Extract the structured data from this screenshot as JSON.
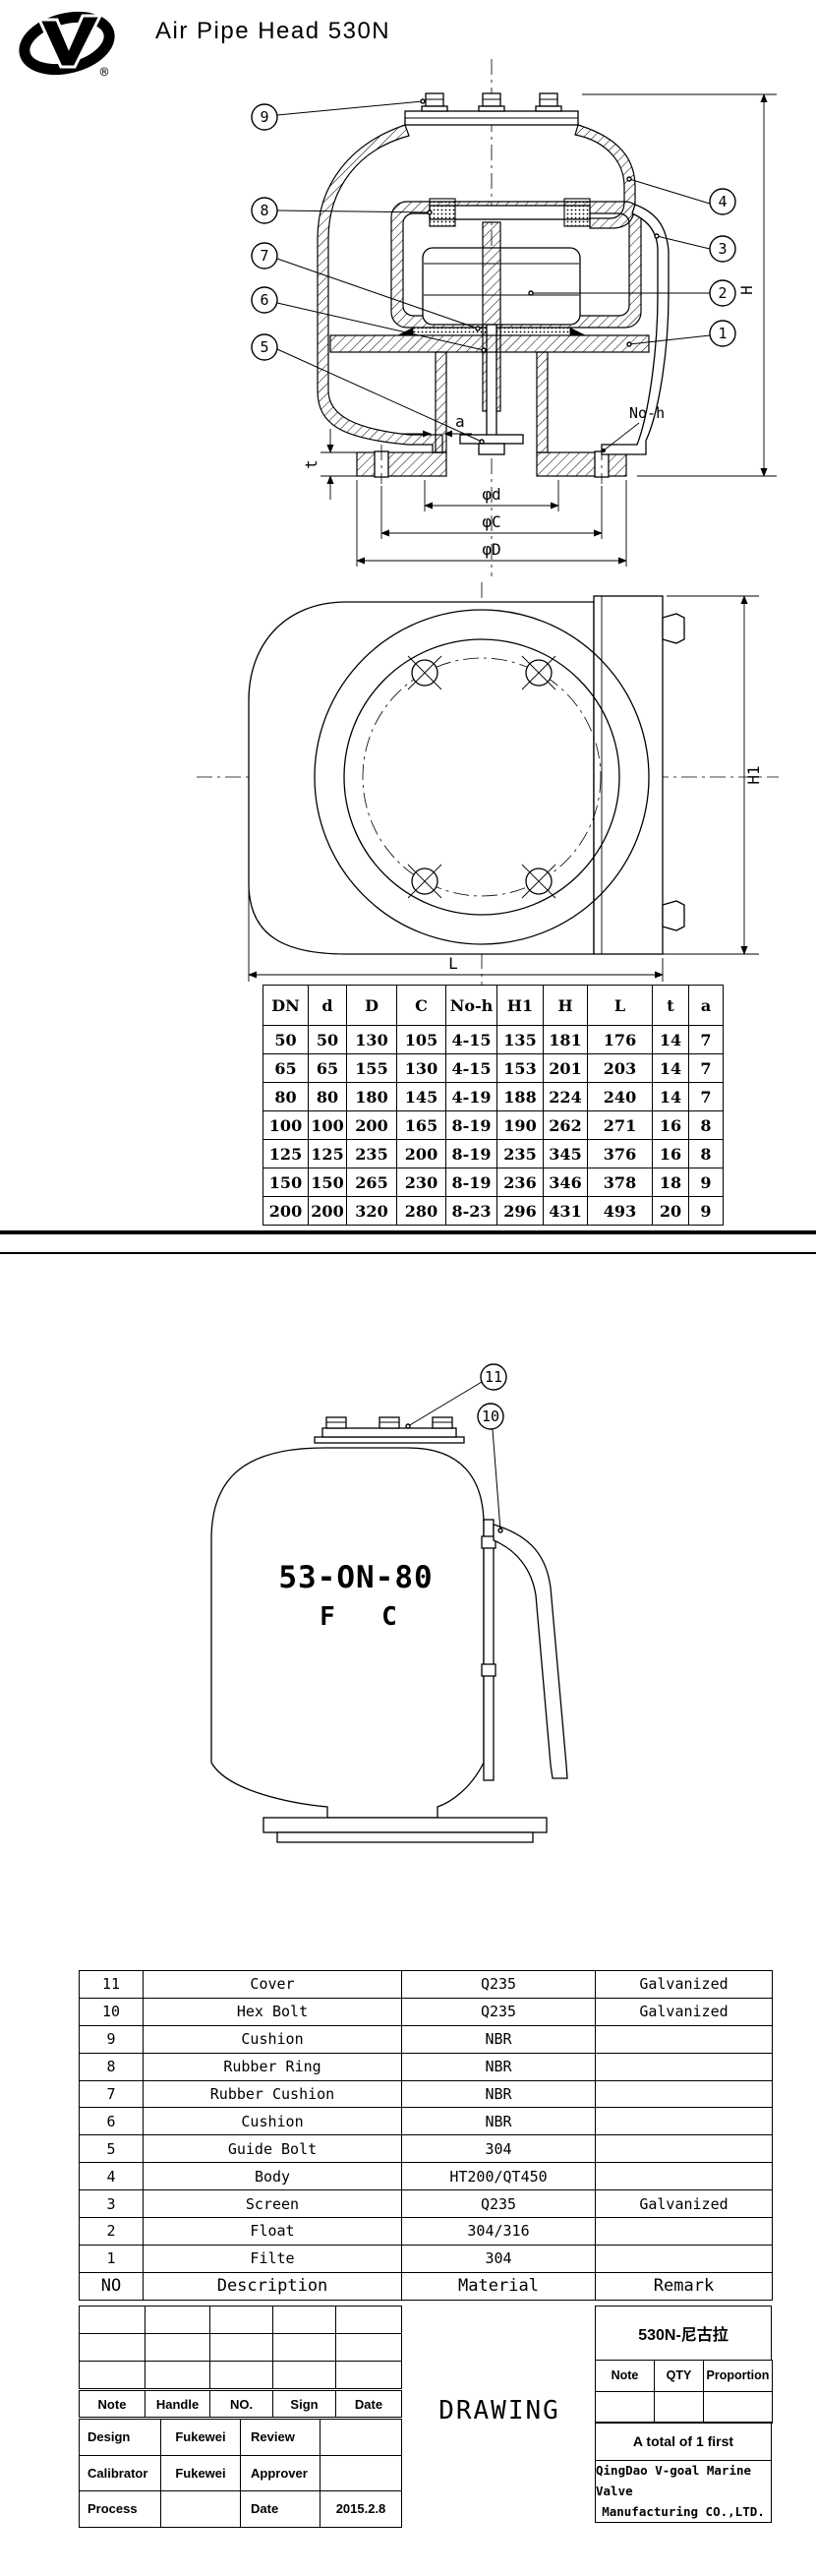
{
  "header": {
    "title": "Air Pipe Head  530N",
    "registered": "®"
  },
  "drawing1": {
    "callouts": [
      "1",
      "2",
      "3",
      "4",
      "5",
      "6",
      "7",
      "8",
      "9"
    ],
    "labels": {
      "a": "a",
      "t": "t",
      "phid": "φd",
      "phic": "φC",
      "phiD": "φD",
      "noh": "No-h",
      "H": "H"
    }
  },
  "top_view": {
    "labels": {
      "H1": "H1",
      "L": "L"
    }
  },
  "dim_table": {
    "header_rows": [
      [
        "DN",
        "d",
        "D",
        "C",
        "No-h",
        "H1",
        "H",
        "L",
        "t",
        "a"
      ]
    ],
    "rows": [
      [
        "50",
        "50",
        "130",
        "105",
        "4-15",
        "135",
        "181",
        "176",
        "14",
        "7"
      ],
      [
        "65",
        "65",
        "155",
        "130",
        "4-15",
        "153",
        "201",
        "203",
        "14",
        "7"
      ],
      [
        "80",
        "80",
        "180",
        "145",
        "4-19",
        "188",
        "224",
        "240",
        "14",
        "7"
      ],
      [
        "100",
        "100",
        "200",
        "165",
        "8-19",
        "190",
        "262",
        "271",
        "16",
        "8"
      ],
      [
        "125",
        "125",
        "235",
        "200",
        "8-19",
        "235",
        "345",
        "376",
        "16",
        "8"
      ],
      [
        "150",
        "150",
        "265",
        "230",
        "8-19",
        "236",
        "346",
        "378",
        "18",
        "9"
      ],
      [
        "200",
        "200",
        "320",
        "280",
        "8-23",
        "296",
        "431",
        "493",
        "20",
        "9"
      ]
    ]
  },
  "drawing2": {
    "callout_11": "11",
    "callout_10": "10",
    "model": "53-ON-80",
    "variant_f": "F",
    "variant_c": "C"
  },
  "parts_table": {
    "rows": [
      [
        "11",
        "Cover",
        "Q235",
        "Galvanized"
      ],
      [
        "10",
        "Hex Bolt",
        "Q235",
        "Galvanized"
      ],
      [
        "9",
        "Cushion",
        "NBR",
        ""
      ],
      [
        "8",
        "Rubber Ring",
        "NBR",
        ""
      ],
      [
        "7",
        "Rubber Cushion",
        "NBR",
        ""
      ],
      [
        "6",
        "Cushion",
        "NBR",
        ""
      ],
      [
        "5",
        "Guide Bolt",
        "304",
        ""
      ],
      [
        "4",
        "Body",
        "HT200/QT450",
        ""
      ],
      [
        "3",
        "Screen",
        "Q235",
        "Galvanized"
      ],
      [
        "2",
        "Float",
        "304/316",
        ""
      ],
      [
        "1",
        "Filte",
        "304",
        ""
      ],
      [
        "NO",
        "Description",
        "Material",
        "Remark"
      ]
    ]
  },
  "title_block": {
    "left": {
      "empty_rows": [
        [
          "",
          "",
          "",
          "",
          ""
        ],
        [
          "",
          "",
          "",
          "",
          ""
        ],
        [
          "",
          "",
          "",
          "",
          ""
        ]
      ],
      "header_rows": [
        [
          "Note",
          "Handle",
          "NO.",
          "Sign",
          "Date"
        ]
      ],
      "rows": [
        [
          "Design",
          "Fukewei",
          "Review",
          ""
        ],
        [
          "Calibrator",
          "Fukewei",
          "Approver",
          ""
        ],
        [
          "Process",
          "",
          "Date",
          "2015.2.8"
        ]
      ]
    },
    "center": {
      "drawing": "DRAWING"
    },
    "right": {
      "title": "530N-尼古拉",
      "header_rows": [
        [
          "Note",
          "QTY",
          "Proportion"
        ],
        [
          "",
          "",
          ""
        ]
      ],
      "total": "A total of 1 first",
      "company_line1": "QingDao V-goal Marine Valve",
      "company_line2": "Manufacturing CO.,LTD."
    }
  }
}
